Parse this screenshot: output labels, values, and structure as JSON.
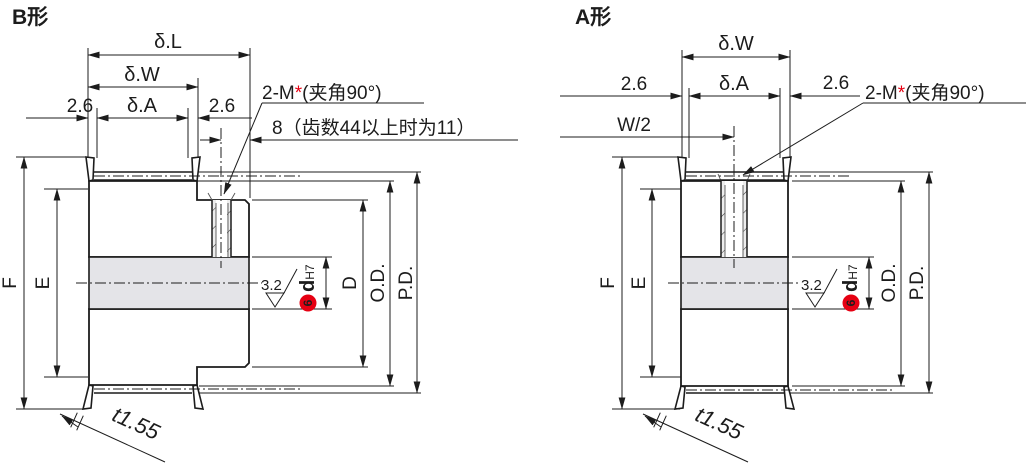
{
  "colors": {
    "line": "#1c1c1c",
    "accent_red": "#e60012",
    "body_fill": "#ededed",
    "bore_fill": "#e4e4e8"
  },
  "b": {
    "title": "B形",
    "delta_L": "δ.L",
    "delta_W": "δ.W",
    "delta_A": "δ.A",
    "offset_left": "2.6",
    "offset_right": "2.6",
    "screw_pre": "2-M",
    "screw_star": "*",
    "screw_post": "(夹角90°)",
    "depth_note": "8（齿数44以上时为11）",
    "dim_F": "F",
    "dim_E": "E",
    "dim_D": "D",
    "dim_OD": "O.D.",
    "dim_PD": "P.D.",
    "surface": "3.2",
    "bore_d": "d",
    "bore_tol": "H7",
    "footnote": "6",
    "flange_t": "t1.55"
  },
  "a": {
    "title": "A形",
    "delta_W": "δ.W",
    "delta_A": "δ.A",
    "offset_left": "2.6",
    "offset_right": "2.6",
    "half_width": "W/2",
    "screw_pre": "2-M",
    "screw_star": "*",
    "screw_post": "(夹角90°)",
    "dim_F": "F",
    "dim_E": "E",
    "dim_OD": "O.D.",
    "dim_PD": "P.D.",
    "surface": "3.2",
    "bore_d": "d",
    "bore_tol": "H7",
    "footnote": "6",
    "flange_t": "t1.55"
  }
}
